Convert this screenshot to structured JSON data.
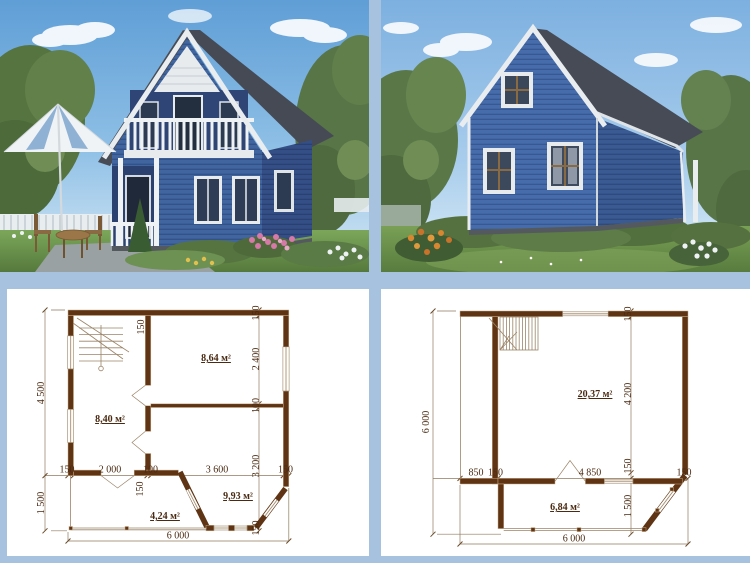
{
  "colors": {
    "frame_blue": "#a6c2df",
    "panel_white": "#ffffff",
    "wall_brown": "#5e3414",
    "dim_text_brown": "#4a2a12",
    "house_siding_blue": "#41659f",
    "roof_gray": "#454a54",
    "trim_white": "#e9edf0",
    "sky_blue": "#5f9ed6",
    "grass_green": "#6f9450"
  },
  "plan_first_floor": {
    "rooms": {
      "left": "8,40 м²",
      "top_right": "8,64 м²",
      "bottom_right": "9,93 м²",
      "porch": "4,24 м²"
    },
    "dims": {
      "left_upper": "4 500",
      "left_lower": "1 500",
      "bottom": "6 000",
      "mid": [
        "150",
        "2 000",
        "100",
        "3 600",
        "150"
      ],
      "right": [
        "150",
        "2 400",
        "100",
        "3 200",
        "150"
      ],
      "wall_top": "150",
      "wall_porch": "150"
    }
  },
  "plan_second_floor": {
    "rooms": {
      "main": "20,37 м²",
      "veranda": "6,84 м²"
    },
    "dims": {
      "left": "6 000",
      "bottom": "6 000",
      "mid": [
        "850",
        "150",
        "4 850",
        "150"
      ],
      "right": [
        "150",
        "4 200",
        "150",
        "1 500"
      ]
    }
  }
}
